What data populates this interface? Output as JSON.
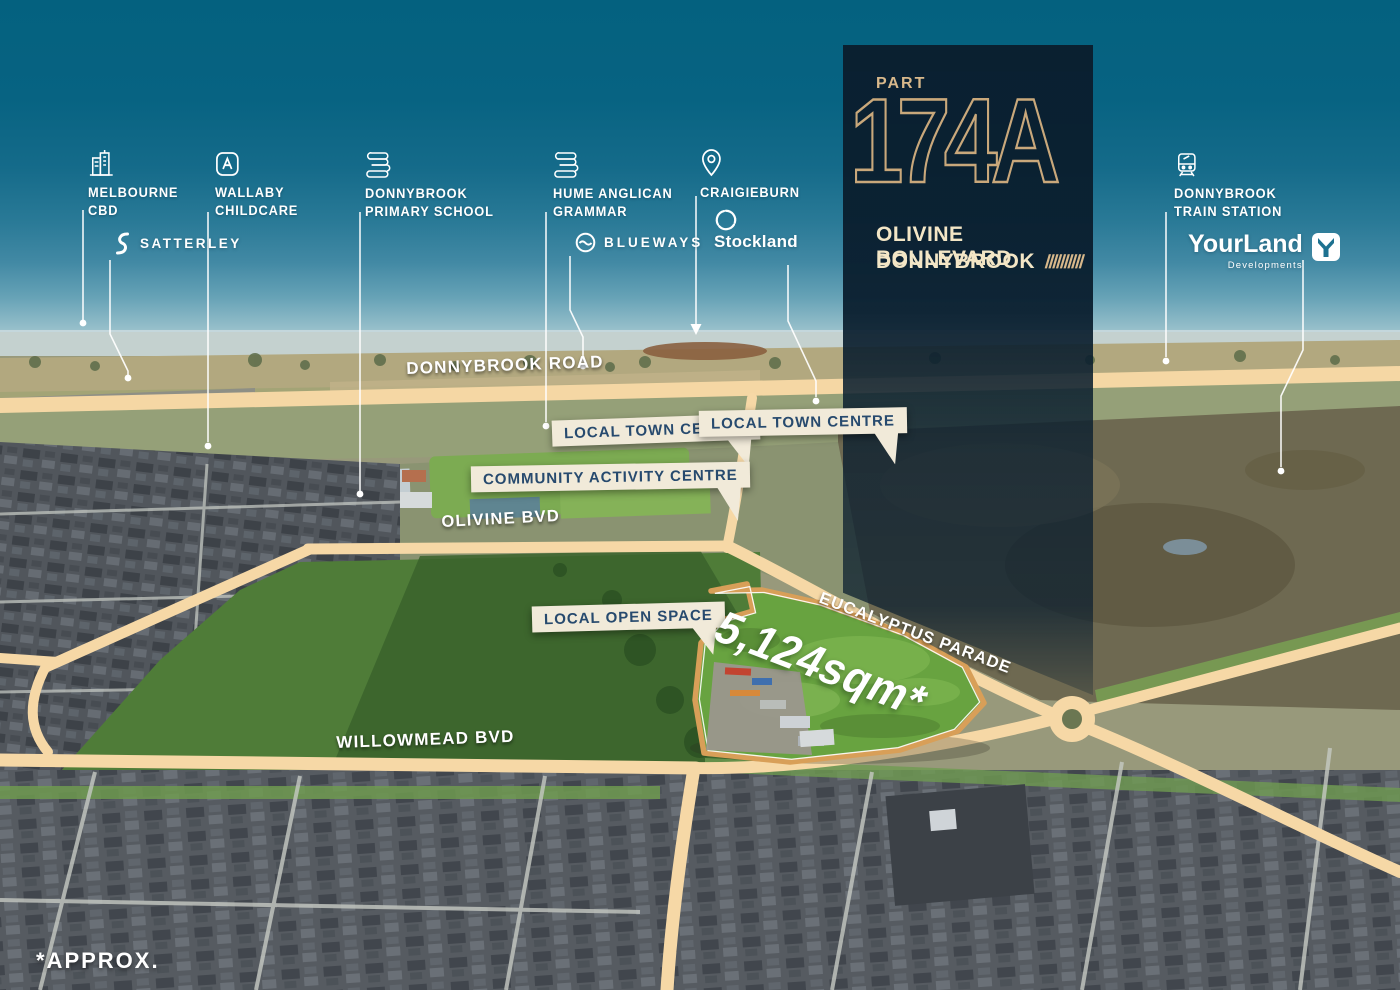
{
  "panel": {
    "part_label": "PART",
    "lot": "174A",
    "address_line1": "OLIVINE BOULEVARD",
    "address_line2": "DONNYBROOK",
    "hatch": "//////////"
  },
  "landmarks": [
    {
      "name": "melbourne-cbd",
      "line1": "MELBOURNE",
      "line2": "CBD"
    },
    {
      "name": "wallaby-childcare",
      "line1": "WALLABY",
      "line2": "CHILDCARE"
    },
    {
      "name": "donnybrook-primary-school",
      "line1": "DONNYBROOK",
      "line2": "PRIMARY SCHOOL"
    },
    {
      "name": "hume-anglican-grammar",
      "line1": "HUME ANGLICAN",
      "line2": "GRAMMAR"
    },
    {
      "name": "craigieburn",
      "line1": "CRAIGIEBURN",
      "line2": ""
    },
    {
      "name": "donnybrook-train-station",
      "line1": "DONNYBROOK",
      "line2": "TRAIN STATION"
    }
  ],
  "logos": {
    "satterley": "SATTERLEY",
    "blueways": "BLUEWAYS",
    "stockland": "Stockland",
    "yourland": "YourLand",
    "yourland_sub": "Developments"
  },
  "callouts": {
    "local_town_centre_1": "LOCAL TOWN CENTRE",
    "local_town_centre_2": "LOCAL TOWN CENTRE",
    "community_activity_centre": "COMMUNITY ACTIVITY CENTRE",
    "local_open_space": "LOCAL OPEN SPACE"
  },
  "road_labels": {
    "donnybrook_road": "DONNYBROOK ROAD",
    "olivine_bvd": "OLIVINE BVD",
    "eucalyptus_parade": "EUCALYPTUS PARADE",
    "willowmead_bvd": "WILLOWMEAD BVD"
  },
  "site": {
    "area": "5,124sqm*"
  },
  "footnote": "*APPROX.",
  "colors": {
    "sky_top": "#04617f",
    "panel_navy": "#0c2132",
    "accent_gold": "#d8b88b",
    "lot_outline_gold": "#c9a87b",
    "callout_bg": "#f1ead9",
    "callout_text": "#274a6e",
    "road_highlight": "#f6d8a6",
    "parcel_green": "#68a340",
    "parcel_border": "#d89f58"
  }
}
